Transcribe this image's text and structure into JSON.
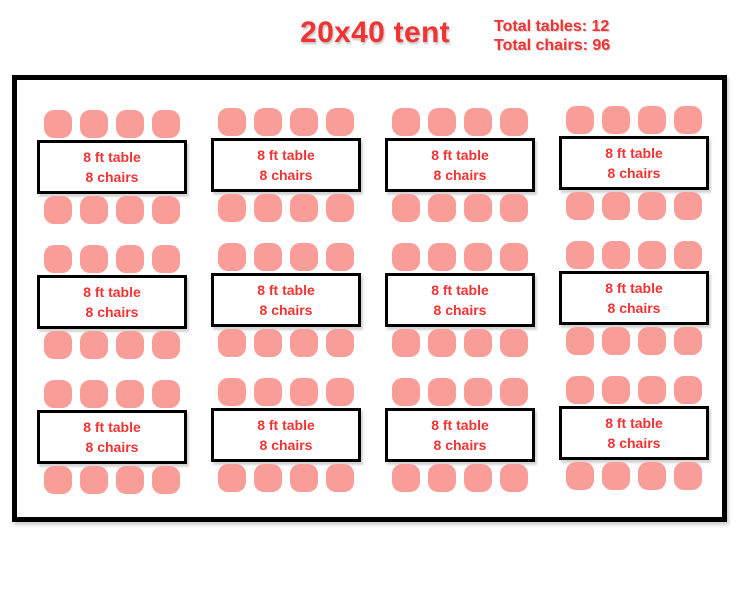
{
  "header": {
    "title": "20x40 tent",
    "stats": {
      "total_tables": "Total tables: 12",
      "total_chairs": "Total chairs: 96"
    }
  },
  "tent": {
    "rows": 3,
    "columns": 4,
    "table_count": 12,
    "chairs_per_side": 4,
    "unit": {
      "line1": "8 ft table",
      "line2": "8 chairs"
    }
  },
  "colors": {
    "text_red": "#F23333",
    "chair_pink": "#F99D99",
    "outline_black": "#000000"
  }
}
